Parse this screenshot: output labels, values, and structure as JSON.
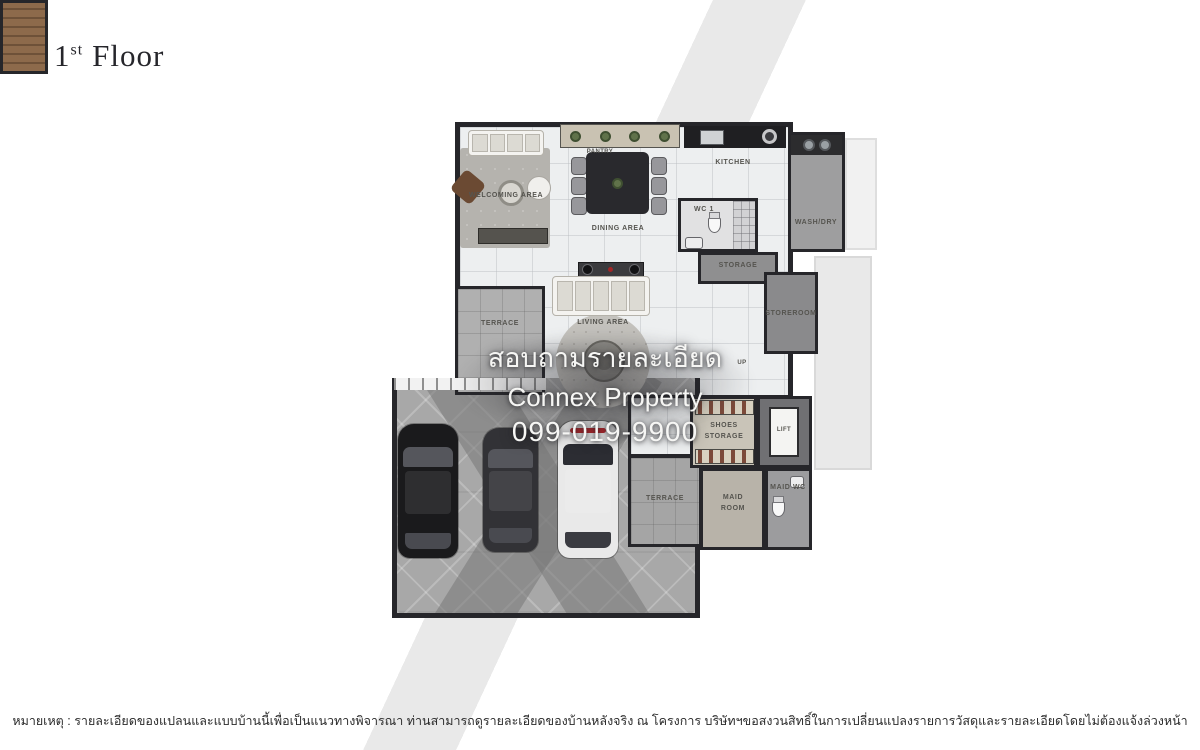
{
  "title": {
    "number": "1",
    "ordinal": "st",
    "word": "Floor"
  },
  "rooms": {
    "welcoming": "WELCOMING AREA",
    "pantry": "PANTRY",
    "dining": "DINING AREA",
    "kitchen": "KITCHEN",
    "washdry": "WASH/DRY",
    "wc1": "WC 1",
    "storage": "STORAGE",
    "storeroom": "STOREROOM",
    "stairs_up": "UP",
    "living": "LIVING AREA",
    "terrace_left": "TERRACE",
    "terrace_bottom": "TERRACE",
    "shoes_storage": "SHOES STORAGE",
    "lift": "LIFT",
    "maid_room": "MAID ROOM",
    "maid_wc": "MAID WC"
  },
  "watermark": {
    "line1": "สอบถามรายละเอียด",
    "line2": "Connex Property",
    "line3": "099-019-9900"
  },
  "disclaimer": "หมายเหตุ : รายละเอียดของแปลนและแบบบ้านนี้เพื่อเป็นแนวทางพิจารณา ท่านสามารถดูรายละเอียดของบ้านหลังจริง ณ โครงการ บริษัทฯขอสงวนสิทธิ์ในการเปลี่ยนแปลงรายการวัสดุและรายละเอียดโดยไม่ต้องแจ้งล่วงหน้า",
  "colors": {
    "wall": "#26262a",
    "marble_floor": "#edeff0",
    "concrete_floor": "#a8a8a8",
    "stair_wood": "#8d6a4b",
    "accent_red": "#b3262b",
    "watermark_text": "#f6f6f4"
  }
}
